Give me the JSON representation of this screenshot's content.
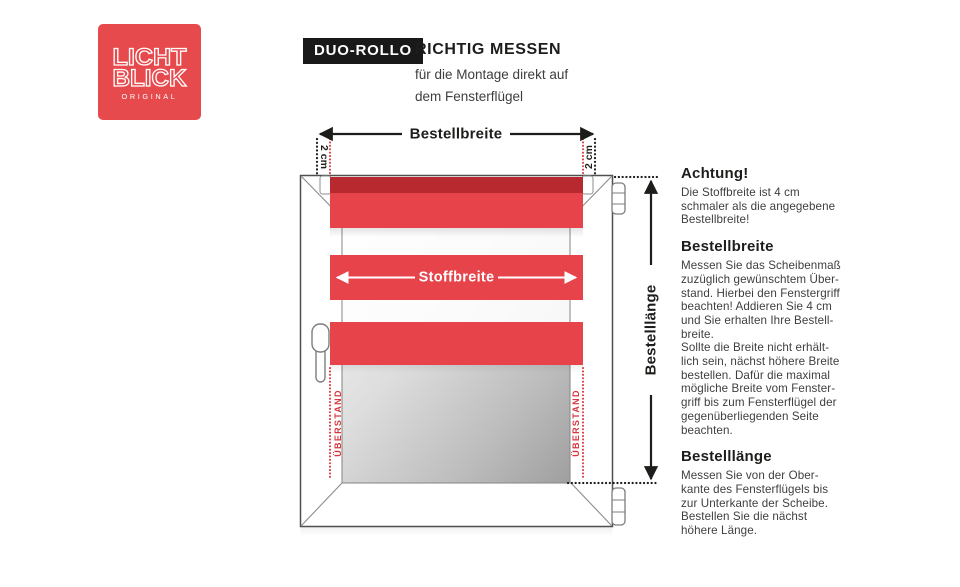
{
  "logo": {
    "line1": "LICHT",
    "line2": "BLICK",
    "sub": "ORIGINAL"
  },
  "header": {
    "badge": "DUO-ROLLO",
    "title": "RICHTIG MESSEN",
    "subtitle": "für die Montage direkt auf\ndem Fensterflügel"
  },
  "diagram": {
    "bestellbreite_label": "Bestellbreite",
    "stoffbreite_label": "Stoffbreite",
    "bestelllaenge_label": "Bestelllänge",
    "two_cm_left": "2 cm",
    "two_cm_right": "2 cm",
    "ueberstand_left": "ÜBERSTAND",
    "ueberstand_right": "ÜBERSTAND"
  },
  "sidebar": {
    "sections": [
      {
        "heading": "Achtung!",
        "body": "Die Stoffbreite ist 4 cm\nschmaler als die angegebene\nBestellbreite!"
      },
      {
        "heading": "Bestellbreite",
        "body": "Messen Sie das Scheibenmaß\nzuzüglich gewünschtem Über-\nstand. Hierbei den Fenstergriff\nbeachten! Addieren Sie 4 cm\nund Sie erhalten Ihre Bestell-\nbreite.\nSollte die Breite nicht erhält-\nlich sein, nächst höhere Breite\nbestellen. Dafür die maximal\nmögliche Breite vom Fenster-\ngriff bis zum Fensterflügel der\ngegenüberliegenden Seite\nbeachten."
      },
      {
        "heading": "Bestelllänge",
        "body": "Messen Sie von der Ober-\nkante des Fensterflügels bis\nzur Unterkante der Scheibe.\nBestellen Sie die nächst\nhöhere Länge."
      }
    ]
  },
  "colors": {
    "brand_red": "#e74a4d",
    "fabric_red": "#e6434a",
    "roller_red": "#b7292e",
    "dotted_red": "#d9363c",
    "badge_black": "#191919"
  }
}
